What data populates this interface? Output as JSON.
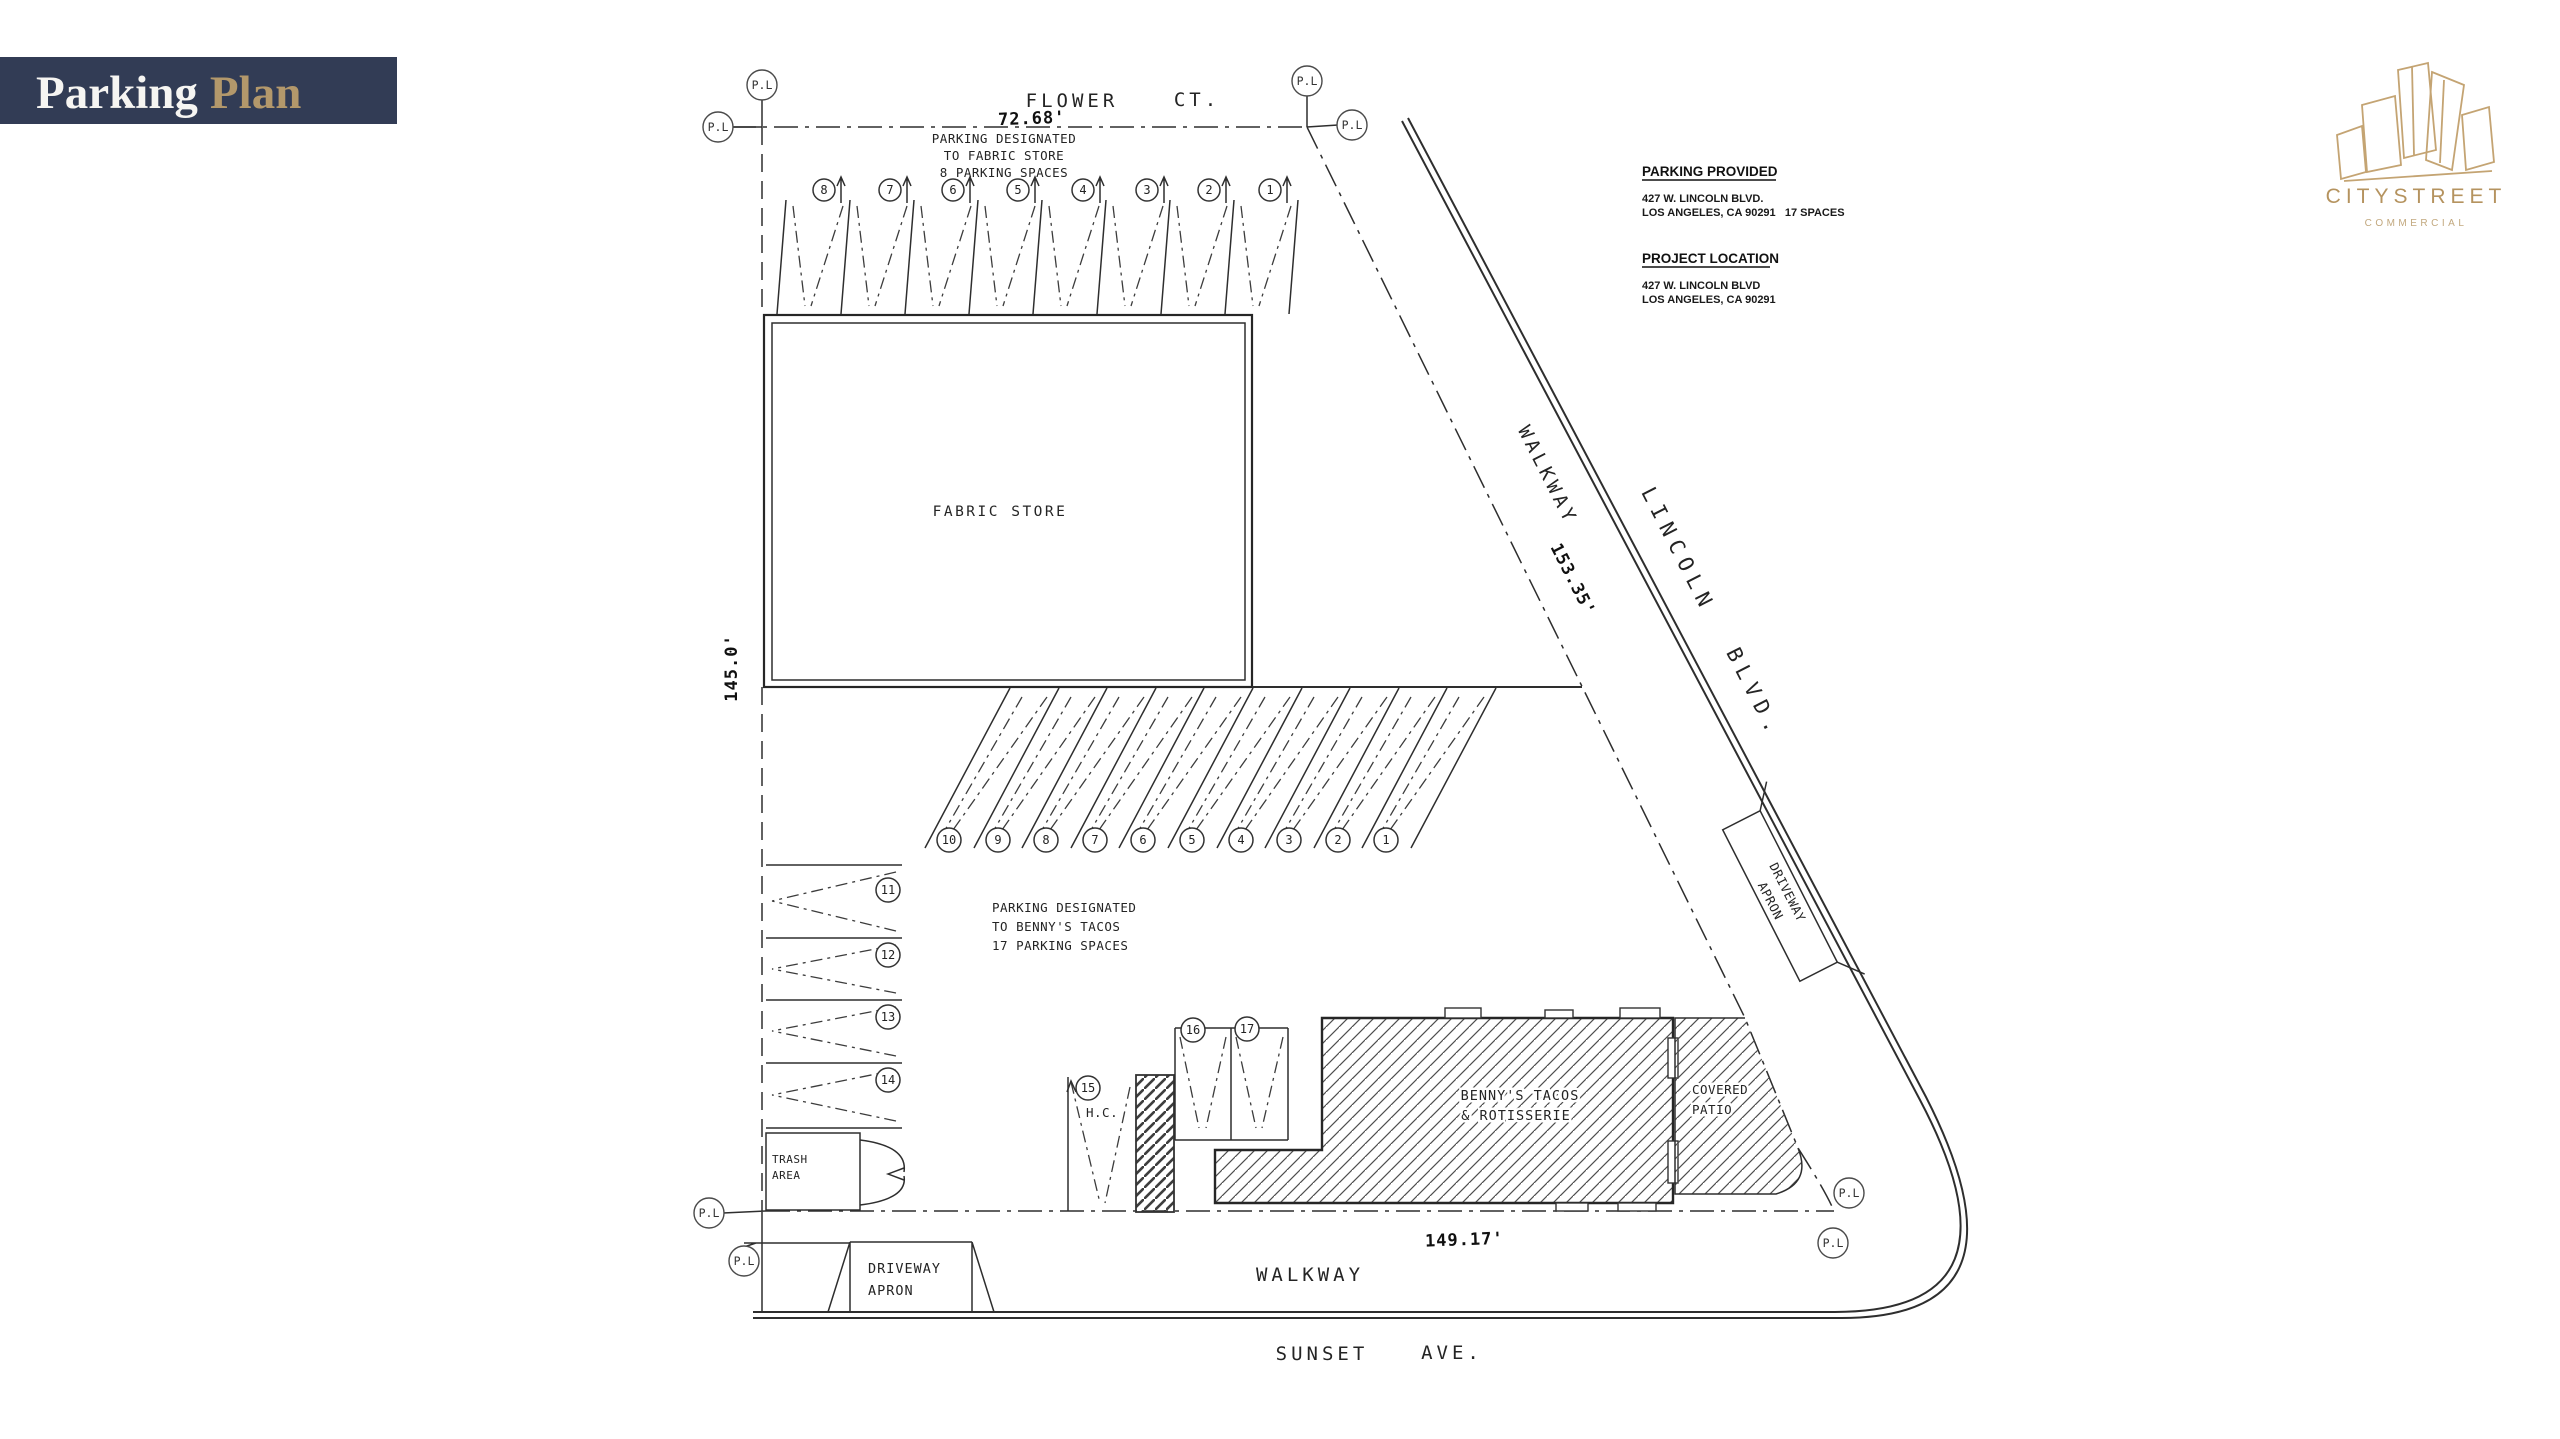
{
  "banner": {
    "title_primary": "Parking",
    "title_secondary": "Plan",
    "bg_color": "#323c55",
    "accent_color": "#b3986b"
  },
  "logo": {
    "name": "CITYSTREET",
    "tagline": "COMMERCIAL",
    "color": "#c4a473"
  },
  "info_panel": {
    "parking_provided_heading": "PARKING PROVIDED",
    "parking_provided_line1": "427 W. LINCOLN BLVD.",
    "parking_provided_line2": "LOS ANGELES, CA 90291   17 SPACES",
    "project_location_heading": "PROJECT LOCATION",
    "project_location_line1": "427 W. LINCOLN BLVD",
    "project_location_line2": "LOS ANGELES, CA 90291"
  },
  "plan": {
    "streets": {
      "top_name": "FLOWER",
      "top_suffix": "CT.",
      "right_name": "LINCOLN",
      "right_suffix": "BLVD.",
      "bottom_name": "SUNSET",
      "bottom_suffix": "AVE."
    },
    "dimensions": {
      "frontage_top": "72.68'",
      "frontage_left": "145.0'",
      "frontage_diagonal": "153.35'",
      "frontage_bottom": "149.17'"
    },
    "notes": {
      "fabric_1": "PARKING DESIGNATED",
      "fabric_2": "TO FABRIC STORE",
      "fabric_3": "8 PARKING SPACES",
      "bennys_1": "PARKING DESIGNATED",
      "bennys_2": "TO BENNY'S TACOS",
      "bennys_3": "17 PARKING SPACES"
    },
    "buildings": {
      "fabric_store": "FABRIC STORE",
      "bennys_1": "BENNY'S TACOS",
      "bennys_2": "& ROTISSERIE",
      "patio_1": "COVERED",
      "patio_2": "PATIO"
    },
    "labels": {
      "walkway_diagonal": "WALKWAY",
      "walkway_bottom": "WALKWAY",
      "driveway_1": "DRIVEWAY",
      "driveway_2": "APRON",
      "trash_1": "TRASH",
      "trash_2": "AREA",
      "handicap": "H.C.",
      "property_line": "P.L"
    },
    "spaces": {
      "top_row": [
        "8",
        "7",
        "6",
        "5",
        "4",
        "3",
        "2",
        "1"
      ],
      "middle_row": [
        "10",
        "9",
        "8",
        "7",
        "6",
        "5",
        "4",
        "3",
        "2",
        "1"
      ],
      "left_column": [
        "11",
        "12",
        "13",
        "14"
      ],
      "bottom_row": [
        "15",
        "16",
        "17"
      ]
    }
  }
}
